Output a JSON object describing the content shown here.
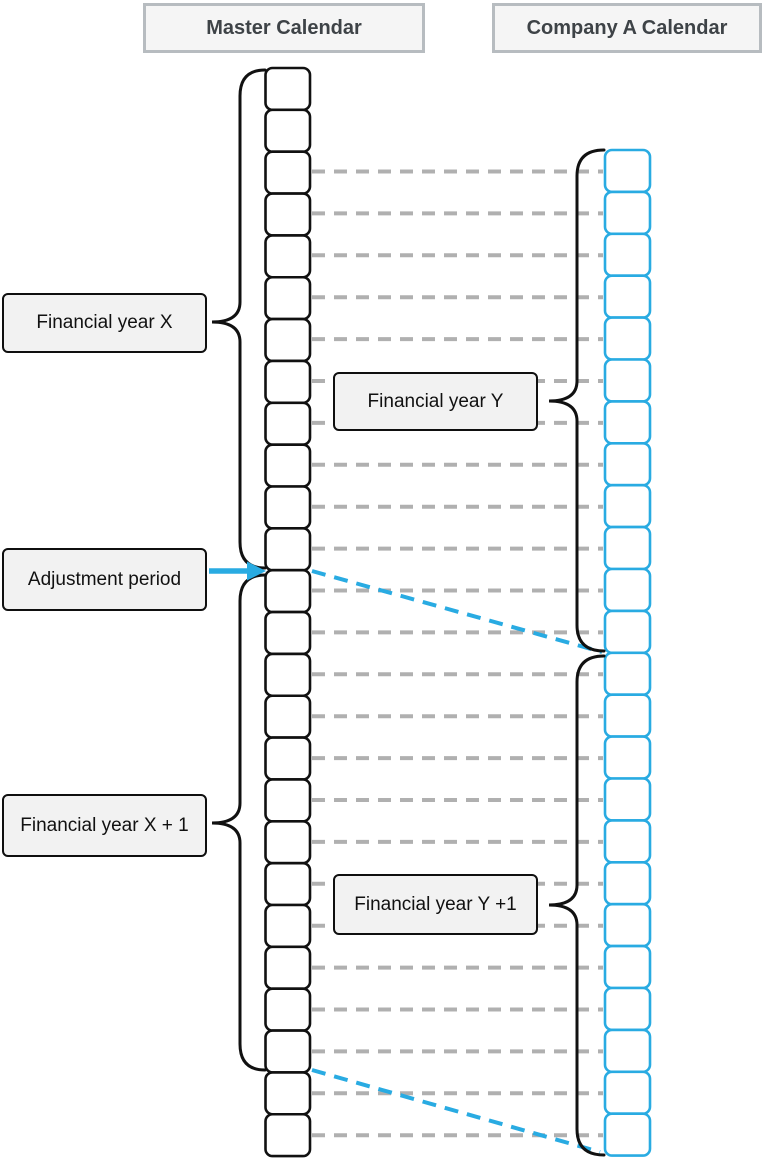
{
  "titles": {
    "master": "Master Calendar",
    "company": "Company A Calendar"
  },
  "labels": {
    "financial_year_x": "Financial year X",
    "adjustment_period": "Adjustment period",
    "financial_year_x_plus_1": "Financial year X + 1",
    "financial_year_y": "Financial year Y",
    "financial_year_y_plus_1": "Financial year Y +1"
  },
  "colors": {
    "company_accent": "#29ABE2",
    "connector_gray": "#b0b0b0",
    "shape_stroke": "#111111",
    "label_fill": "#f2f2f2",
    "title_fill": "#f5f5f5",
    "title_border": "#b7bcc0",
    "title_text": "#3e4347"
  },
  "diagram": {
    "canvas": {
      "width": 765,
      "height": 1159
    },
    "master_column": {
      "x": 265.5,
      "width": 44.5,
      "top": 68,
      "cell_height": 41.85,
      "cells": 26,
      "stroke": "#111111",
      "stroke_width": 2.6,
      "radius": 7
    },
    "company_column": {
      "x": 605,
      "width": 45,
      "top": 150,
      "cell_height": 41.9,
      "cells": 24,
      "stroke": "#29ABE2",
      "stroke_width": 2.6,
      "radius": 7
    },
    "connectors": {
      "x1": 312,
      "x2": 603,
      "first_y": 171.5,
      "spacing": 41.9,
      "count": 24,
      "color": "#b0b0b0",
      "width": 4,
      "dash": "13 9"
    },
    "diagonal_style": {
      "color": "#29ABE2",
      "width": 4,
      "dash": "14 9"
    },
    "diagonals": [
      {
        "x1": 312,
        "y1": 571,
        "x2": 602,
        "y2": 652
      },
      {
        "x1": 312,
        "y1": 1070,
        "x2": 600,
        "y2": 1152
      }
    ],
    "brace_style": {
      "color": "#111111",
      "width": 3,
      "end_radius": 26,
      "tip_radius": 20
    },
    "braces": [
      {
        "name": "brace-financial-year-x",
        "x_end": 265,
        "x_spine": 240,
        "x_tip": 212,
        "y_top": 70,
        "y_bottom": 568,
        "y_tip": 322
      },
      {
        "name": "brace-financial-year-x-plus-1",
        "x_end": 265,
        "x_spine": 240,
        "x_tip": 212,
        "y_top": 575,
        "y_bottom": 1070,
        "y_tip": 823
      },
      {
        "name": "brace-financial-year-y",
        "x_end": 604,
        "x_spine": 577,
        "x_tip": 549,
        "y_top": 150,
        "y_bottom": 651,
        "y_tip": 401
      },
      {
        "name": "brace-financial-year-y-plus-1",
        "x_end": 604,
        "x_spine": 577,
        "x_tip": 549,
        "y_top": 656,
        "y_bottom": 1155,
        "y_tip": 905
      }
    ],
    "arrow": {
      "x1": 209,
      "x2": 250,
      "y": 571,
      "head_x": 266,
      "head_base_x": 247,
      "head_half_height": 9.5,
      "color": "#29ABE2",
      "shaft_width": 5.5
    }
  }
}
